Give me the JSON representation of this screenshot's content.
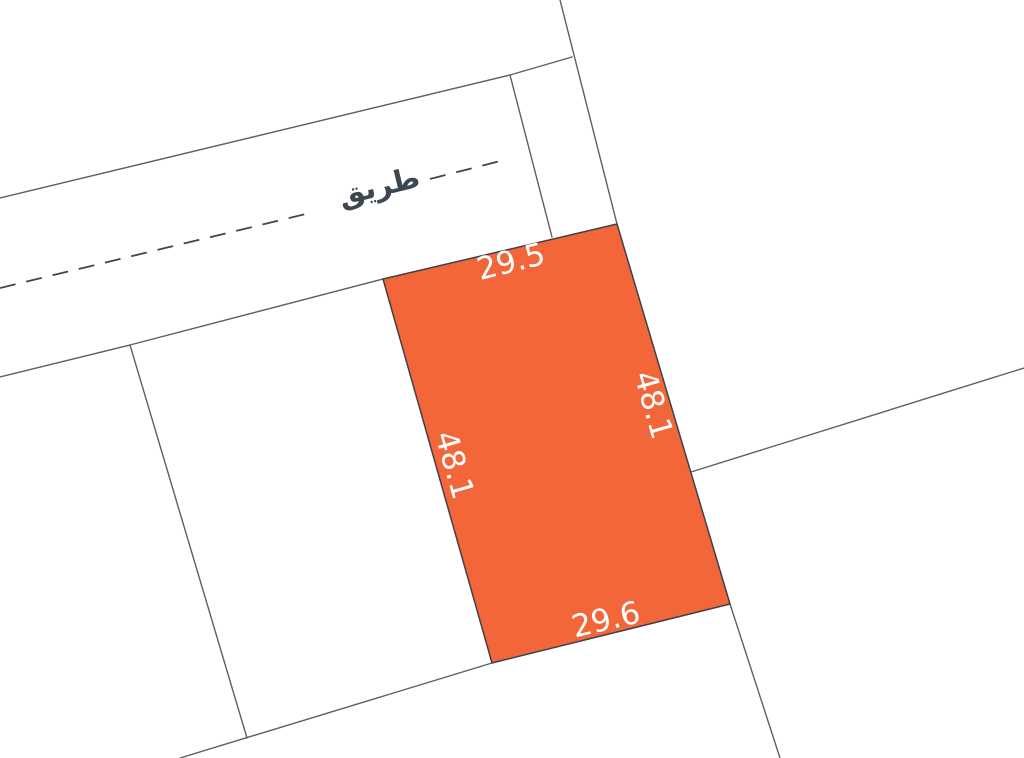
{
  "map": {
    "road": {
      "label": "طريق"
    },
    "selected_parcel": {
      "fill_color": "#F2663A",
      "dimensions": {
        "top": "29.5",
        "right": "48.1",
        "left": "48.1",
        "bottom": "29.6"
      }
    },
    "colors": {
      "background": "#ffffff",
      "boundary": "#5c6065",
      "centerline": "#3f464e",
      "dimension_text": "#ffffff",
      "road_label_text": "#3d4752"
    }
  }
}
